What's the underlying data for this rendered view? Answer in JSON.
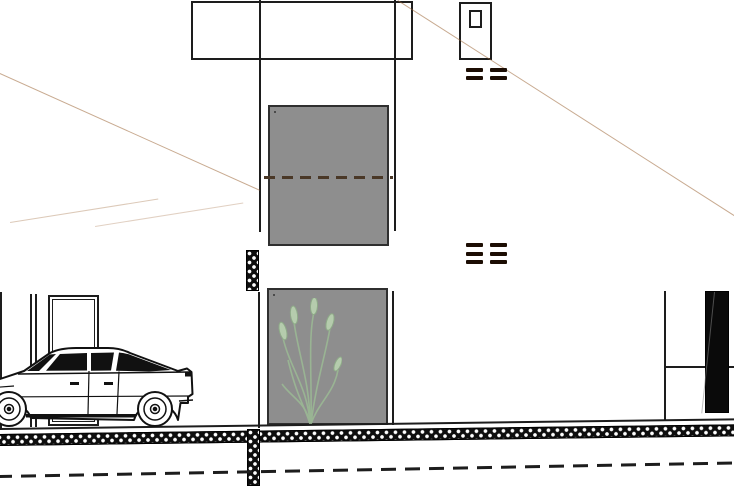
{
  "scene": {
    "name": "house-front-elevation-drawing"
  },
  "colors": {
    "background": "#ffffff",
    "panel_brown": "#5b2c0e",
    "panel_grain": "#9a6434",
    "outline": "#1d1d1d",
    "frame_gray": "#8e8e8e",
    "glass_top": "#c6e9d9",
    "glass_bottom": "#fcfffd",
    "hatch_black": "#0e0e0e",
    "opening_dark": "#0a0a0a",
    "window_dash": "#4a3827",
    "plant_green": "#9cbb95",
    "plant_head": "#bad3b1"
  },
  "roof_panels": {
    "left": {
      "slot_y": 256,
      "slot_w": 6,
      "slot_h": 13,
      "slot_xs": [
        -2,
        30,
        62,
        93,
        124,
        155,
        186,
        217
      ]
    },
    "right": {
      "vent_groups": [
        {
          "x_cols": [
            466,
            490
          ],
          "row_ys": [
            68,
            76
          ],
          "dash_w": 17,
          "dash_h": 4
        },
        {
          "x_cols": [
            466,
            490
          ],
          "row_ys": [
            243,
            252,
            260
          ],
          "dash_w": 17,
          "dash_h": 4
        }
      ]
    }
  }
}
